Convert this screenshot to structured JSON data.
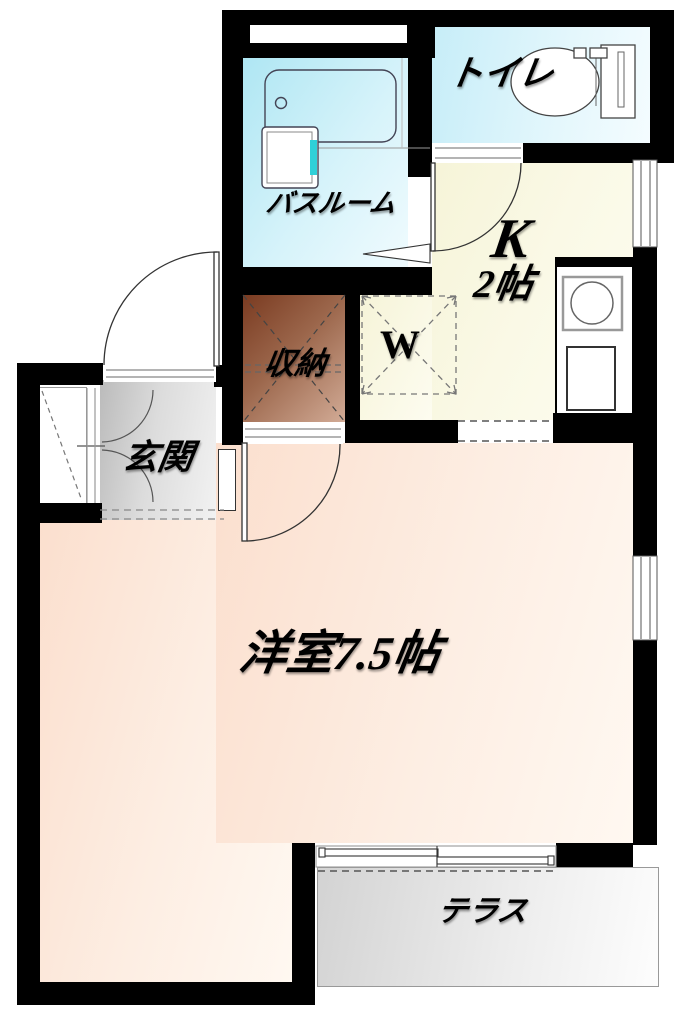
{
  "rooms": {
    "toilet": {
      "label": "トイレ"
    },
    "bathroom": {
      "label": "バスルーム"
    },
    "kitchen": {
      "label": "K",
      "size": "2帖"
    },
    "washer_pan": {
      "label": "W"
    },
    "closet": {
      "label": "収納"
    },
    "entrance": {
      "label": "玄関"
    },
    "western_room": {
      "label": "洋室7.5帖"
    },
    "terrace": {
      "label": "テラス"
    }
  },
  "colors": {
    "wall": "#000000",
    "bathroom_floor": "#aee6f3",
    "toilet_floor": "#c6edf8",
    "kitchen_floor": "#f6f4d8",
    "closet_floor_dark": "#7a3b21",
    "closet_floor_light": "#d2ab96",
    "entrance_floor": "#bbbbbb",
    "room_floor": "#fbdfce",
    "terrace_floor": "#d3d3d3",
    "vanity_accent": "#2fd0d8",
    "line": "#333333"
  }
}
